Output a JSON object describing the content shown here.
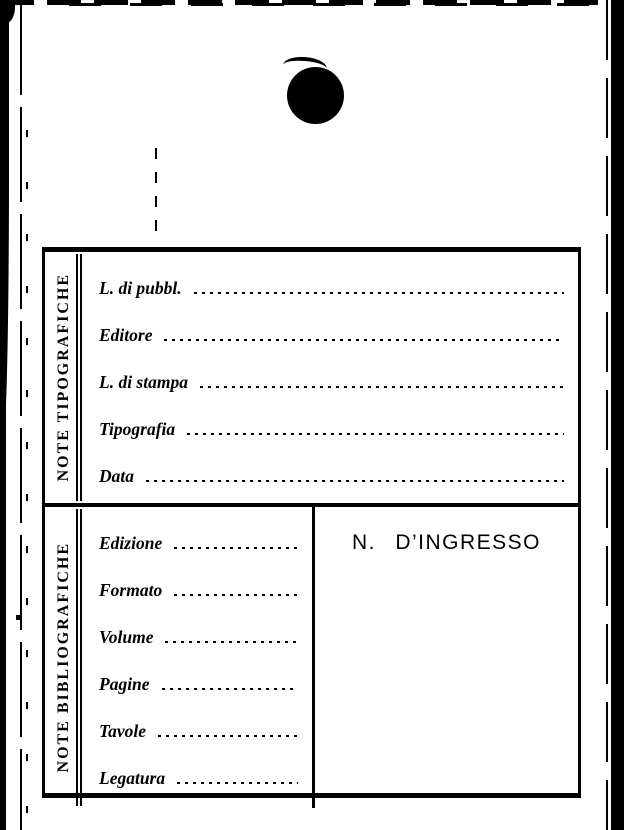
{
  "colors": {
    "ink": "#000000",
    "paper": "#ffffff"
  },
  "icons": {
    "punch_hole": "filled-circle"
  },
  "card": {
    "typographic_section": {
      "side_label": "NOTE TIPOGRAFICHE",
      "fields": [
        {
          "label": "L. di pubbl.",
          "value": ""
        },
        {
          "label": "Editore",
          "value": ""
        },
        {
          "label": "L. di stampa",
          "value": ""
        },
        {
          "label": "Tipografia",
          "value": ""
        },
        {
          "label": "Data",
          "value": ""
        }
      ]
    },
    "bibliographic_section": {
      "side_label": "NOTE BIBLIOGRAFICHE",
      "fields": [
        {
          "label": "Edizione",
          "value": ""
        },
        {
          "label": "Formato",
          "value": ""
        },
        {
          "label": "Volume",
          "value": ""
        },
        {
          "label": "Pagine",
          "value": ""
        },
        {
          "label": "Tavole",
          "value": ""
        },
        {
          "label": "Legatura",
          "value": ""
        }
      ],
      "ingresso_cell": {
        "title": "N. D’INGRESSO",
        "value": ""
      }
    }
  }
}
